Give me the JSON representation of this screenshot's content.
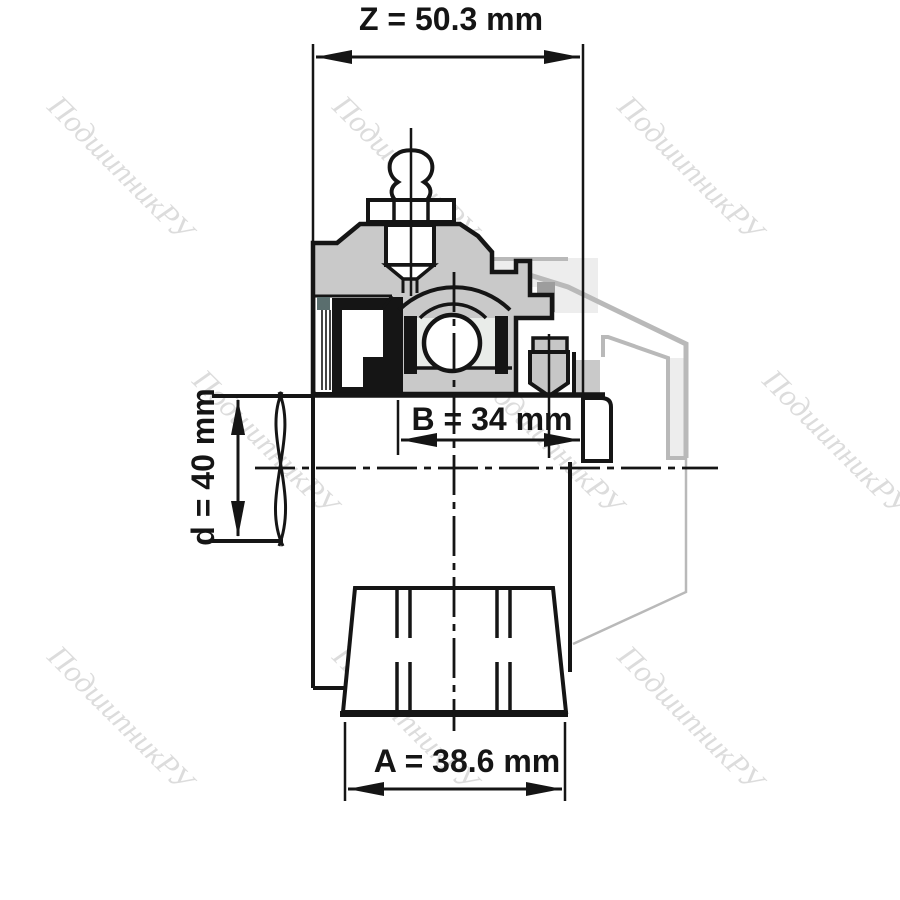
{
  "watermark": {
    "text": "ПодшипникРУ",
    "color": "#dcdcdc"
  },
  "dimensions": {
    "total_width": {
      "label": "Z = 50.3 mm"
    },
    "insert_width": {
      "label": "B = 34 mm"
    },
    "bore_diameter": {
      "label": "d = 40 mm"
    },
    "flange_width": {
      "label": "A = 38.6 mm"
    }
  },
  "colors": {
    "outline": "#151515",
    "section_fill": "#c9c9c9",
    "ghost_stroke": "#b9b9b9",
    "ghost_fill": "#ededed",
    "ghost_dark_fill": "#9d9d9d",
    "seal_accent": "#5a6e6e",
    "raceway_fill": "#e9ece9",
    "screw_fill": "#c6c6c6"
  }
}
